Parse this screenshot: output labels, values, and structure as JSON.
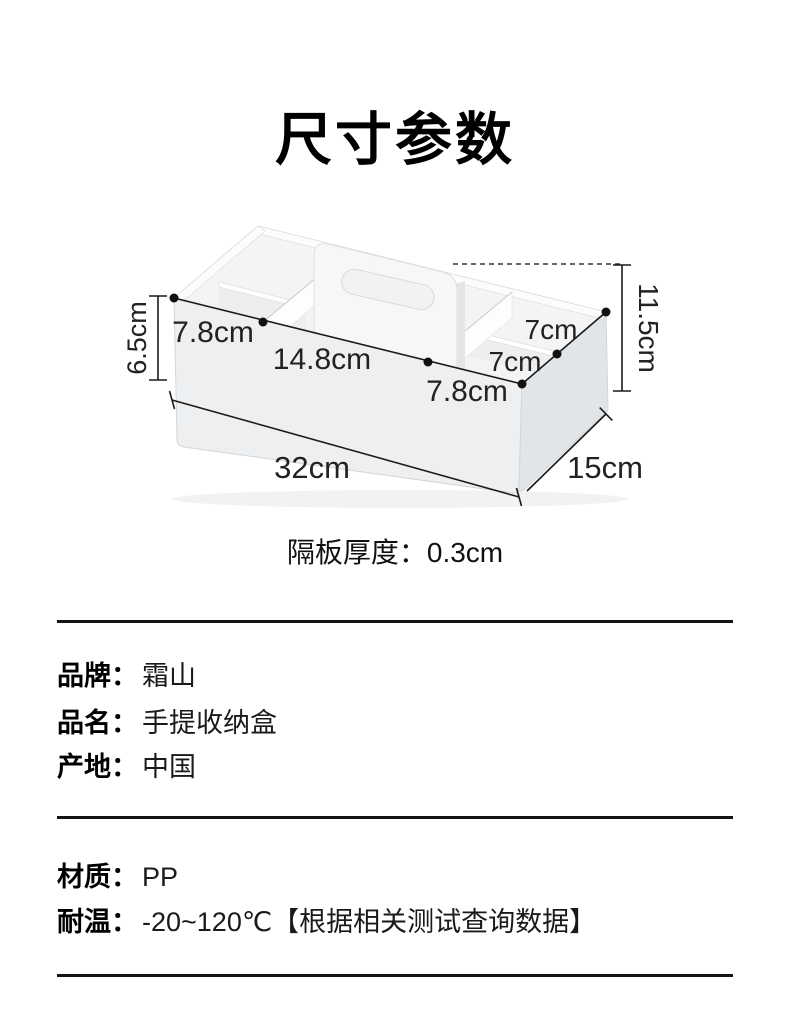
{
  "page": {
    "title": "尺寸参数",
    "background": "#ffffff",
    "text_color": "#000000",
    "box_color": "#edeff1"
  },
  "diagram": {
    "dims": {
      "height_front": "6.5cm",
      "height_total": "11.5cm",
      "compartment_front_left": "7.8cm",
      "compartment_front_middle": "14.8cm",
      "compartment_front_right": "7.8cm",
      "compartment_right_back": "7cm",
      "compartment_right_front": "7cm",
      "length": "32cm",
      "depth": "15cm"
    },
    "partition_note_label": "隔板厚度：",
    "partition_note_value": "0.3cm"
  },
  "specs": {
    "rows": [
      {
        "label": "品牌：",
        "value": "霜山"
      },
      {
        "label": "品名：",
        "value": "手提收纳盒"
      },
      {
        "label": "产地：",
        "value": "中国"
      },
      {
        "label": "材质：",
        "value": "PP"
      },
      {
        "label": "耐温：",
        "value": "-20~120℃【根据相关测试查询数据】"
      }
    ]
  }
}
